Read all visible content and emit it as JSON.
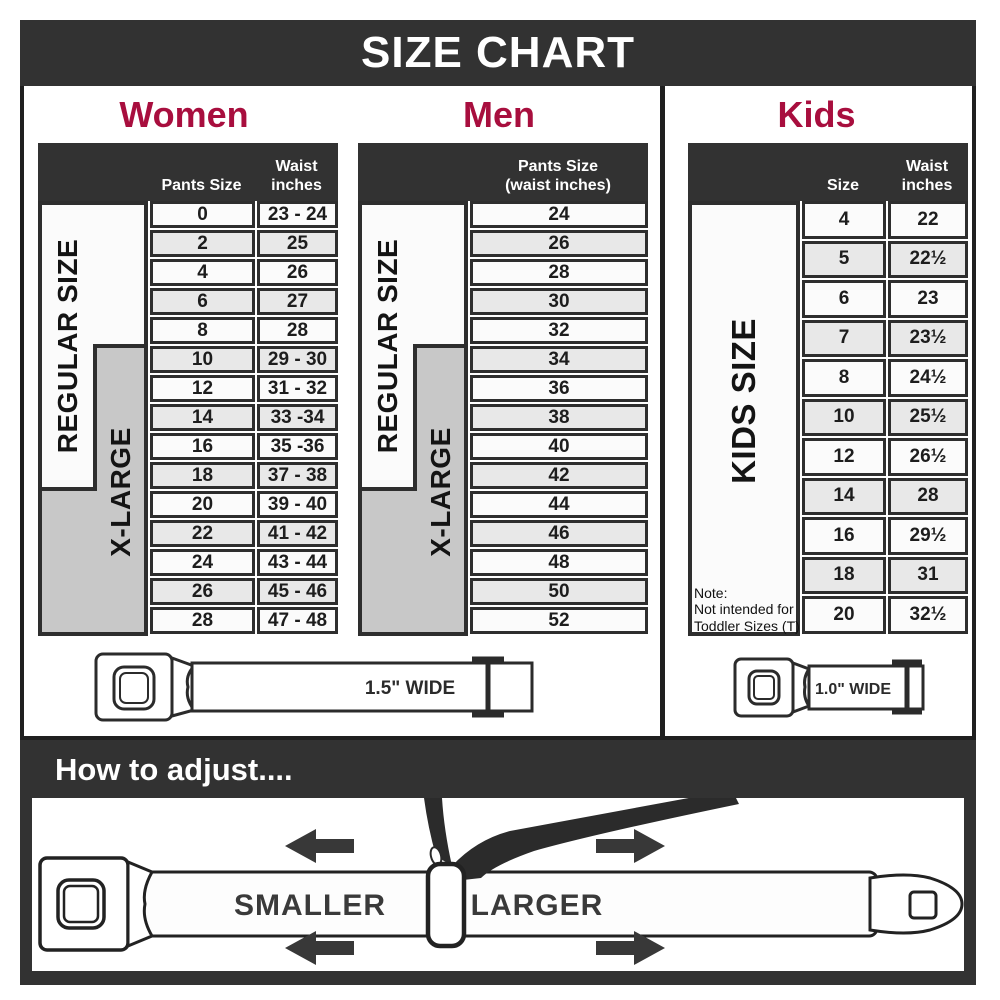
{
  "title": "SIZE CHART",
  "colors": {
    "accent": "#a80e3e",
    "dark": "#323232",
    "xlarge_gray": "#c8c8c8",
    "row_alt": "#e8e8e8"
  },
  "women": {
    "title": "Women",
    "regular_label": "REGULAR SIZE",
    "xlarge_label": "X-LARGE",
    "headers": {
      "pants": "Pants Size",
      "waist_line1": "Waist",
      "waist_line2": "inches"
    },
    "rows": [
      [
        "0",
        "23 - 24"
      ],
      [
        "2",
        "25"
      ],
      [
        "4",
        "26"
      ],
      [
        "6",
        "27"
      ],
      [
        "8",
        "28"
      ],
      [
        "10",
        "29 - 30"
      ],
      [
        "12",
        "31 - 32"
      ],
      [
        "14",
        "33 -34"
      ],
      [
        "16",
        "35 -36"
      ],
      [
        "18",
        "37 - 38"
      ],
      [
        "20",
        "39 - 40"
      ],
      [
        "22",
        "41 - 42"
      ],
      [
        "24",
        "43 - 44"
      ],
      [
        "26",
        "45 - 46"
      ],
      [
        "28",
        "47 - 48"
      ]
    ],
    "belt_width_label": "1.5\" WIDE"
  },
  "men": {
    "title": "Men",
    "regular_label": "REGULAR SIZE",
    "xlarge_label": "X-LARGE",
    "headers": {
      "line1": "Pants Size",
      "line2": "(waist inches)"
    },
    "rows": [
      "24",
      "26",
      "28",
      "30",
      "32",
      "34",
      "36",
      "38",
      "40",
      "42",
      "44",
      "46",
      "48",
      "50",
      "52"
    ]
  },
  "kids": {
    "title": "Kids",
    "side_label": "KIDS SIZE",
    "headers": {
      "size": "Size",
      "waist_line1": "Waist",
      "waist_line2": "inches"
    },
    "rows": [
      [
        "4",
        "22"
      ],
      [
        "5",
        "22½"
      ],
      [
        "6",
        "23"
      ],
      [
        "7",
        "23½"
      ],
      [
        "8",
        "24½"
      ],
      [
        "10",
        "25½"
      ],
      [
        "12",
        "26½"
      ],
      [
        "14",
        "28"
      ],
      [
        "16",
        "29½"
      ],
      [
        "18",
        "31"
      ],
      [
        "20",
        "32½"
      ]
    ],
    "note_line1": "Note:",
    "note_line2": "Not intended for",
    "note_line3": "Toddler Sizes (T)",
    "belt_width_label": "1.0\" WIDE"
  },
  "adjust": {
    "title": "How to adjust....",
    "smaller_label": "SMALLER",
    "larger_label": "LARGER"
  }
}
